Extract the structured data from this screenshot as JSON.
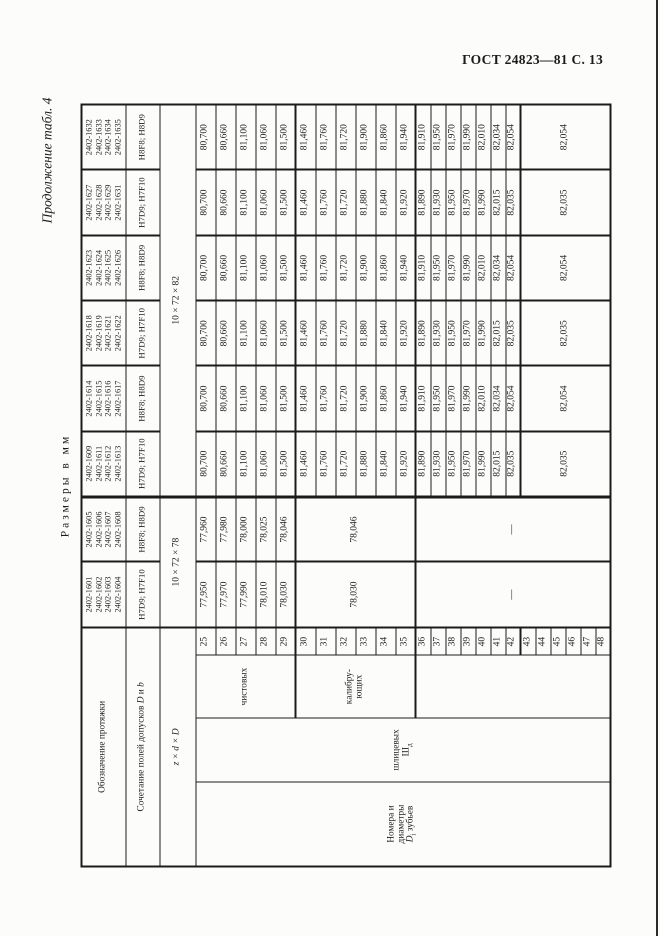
{
  "page": {
    "gost_header": "ГОСТ 24823—81 С. 13",
    "continuation_note": "Продолжение табл. 4",
    "units_heading": "Размеры в мм"
  },
  "table": {
    "corner_labels": {
      "designation": "Обозначение протяжки",
      "tolerance_pre": "Сочетание полей допусков",
      "tolerance_d": "D",
      "tolerance_and": "и",
      "tolerance_b": "b",
      "size_formula": "z × d × D"
    },
    "left_header": {
      "numbers_line1": "Номера и",
      "numbers_line2": "диаметры",
      "numbers_d": "D",
      "numbers_d_sub": "i",
      "numbers_rest": "зубьев",
      "splined_word": "шлицевых",
      "splined_base": "Ш",
      "splined_sub": "д",
      "category_finishing": "чистовых",
      "category_calibrating": [
        "калибру-",
        "ющих"
      ]
    },
    "size_spans": [
      {
        "label": "10 × 72 × 78",
        "span": 2
      },
      {
        "label": "10 × 72 × 82",
        "span": 6
      }
    ],
    "groups": [
      {
        "designations": [
          "2402-1601",
          "2402-1602",
          "2402-1603",
          "2402-1604"
        ],
        "tolerance": "H7D9; H7F10"
      },
      {
        "designations": [
          "2402-1605",
          "2402-1606",
          "2402-1607",
          "2402-1608"
        ],
        "tolerance": "H8F8; H8D9"
      },
      {
        "designations": [
          "2402-1609",
          "2402-1611",
          "2402-1612",
          "2402-1613"
        ],
        "tolerance": "H7D9; H7F10"
      },
      {
        "designations": [
          "2402-1614",
          "2402-1615",
          "2402-1616",
          "2402-1617"
        ],
        "tolerance": "H8F8; H8D9"
      },
      {
        "designations": [
          "2402-1618",
          "2402-1619",
          "2402-1621",
          "2402-1622"
        ],
        "tolerance": "H7D9; H7F10"
      },
      {
        "designations": [
          "2402-1623",
          "2402-1624",
          "2402-1625",
          "2402-1626"
        ],
        "tolerance": "H8F8; H8D9"
      },
      {
        "designations": [
          "2402-1627",
          "2402-1628",
          "2402-1629",
          "2402-1631"
        ],
        "tolerance": "H7D9; H7F10"
      },
      {
        "designations": [
          "2402-1632",
          "2402-1633",
          "2402-1634",
          "2402-1635"
        ],
        "tolerance": "H8F8; H8D9"
      }
    ],
    "rows": [
      {
        "n": "25",
        "thick": false,
        "cat": {
          "lines": [
            "чистовых"
          ],
          "rs": 5
        },
        "cells": [
          "77,950",
          "77,960",
          "80,700",
          "80,700",
          "80,700",
          "80,700",
          "80,700",
          "80,700"
        ]
      },
      {
        "n": "26",
        "thick": false,
        "cells": [
          "77,970",
          "77,980",
          "80,660",
          "80,660",
          "80,660",
          "80,660",
          "80,660",
          "80,660"
        ]
      },
      {
        "n": "27",
        "thick": false,
        "cells": [
          "77,990",
          "78,000",
          "81,100",
          "81,100",
          "81,100",
          "81,100",
          "81,100",
          "81,100"
        ]
      },
      {
        "n": "28",
        "thick": false,
        "cells": [
          "78,010",
          "78,025",
          "81,060",
          "81,060",
          "81,060",
          "81,060",
          "81,060",
          "81,060"
        ]
      },
      {
        "n": "29",
        "thick": false,
        "cells": [
          "78,030",
          "78,046",
          "81,500",
          "81,500",
          "81,500",
          "81,500",
          "81,500",
          "81,500"
        ]
      },
      {
        "n": "30",
        "thick": true,
        "cat": {
          "lines": [
            "калибру-",
            "ющих"
          ],
          "rs": 6
        },
        "cells": [
          {
            "v": "78,030",
            "rs": 6
          },
          {
            "v": "78,046",
            "rs": 6
          },
          "81,460",
          "81,460",
          "81,460",
          "81,460",
          "81,460",
          "81,460"
        ]
      },
      {
        "n": "31",
        "thick": false,
        "cells": [
          null,
          null,
          "81,760",
          "81,760",
          "81,760",
          "81,760",
          "81,760",
          "81,760"
        ]
      },
      {
        "n": "32",
        "thick": false,
        "cells": [
          null,
          null,
          "81,720",
          "81,720",
          "81,720",
          "81,720",
          "81,720",
          "81,720"
        ]
      },
      {
        "n": "33",
        "thick": false,
        "cells": [
          null,
          null,
          "81,880",
          "81,900",
          "81,880",
          "81,900",
          "81,880",
          "81,900"
        ]
      },
      {
        "n": "34",
        "thick": false,
        "cells": [
          null,
          null,
          "81,840",
          "81,860",
          "81,840",
          "81,860",
          "81,840",
          "81,860"
        ]
      },
      {
        "n": "35",
        "thick": false,
        "cells": [
          null,
          null,
          "81,920",
          "81,940",
          "81,920",
          "81,940",
          "81,920",
          "81,940"
        ]
      },
      {
        "n": "36",
        "thick": true,
        "cat": {
          "lines": [],
          "rs": 13
        },
        "cells": [
          {
            "v": "—",
            "rs": 13
          },
          {
            "v": "—",
            "rs": 13
          },
          "81,890",
          "81,910",
          "81,890",
          "81,910",
          "81,890",
          "81,910"
        ]
      },
      {
        "n": "37",
        "thick": false,
        "cells": [
          null,
          null,
          "81,930",
          "81,950",
          "81,930",
          "81,950",
          "81,930",
          "81,950"
        ]
      },
      {
        "n": "38",
        "thick": false,
        "cells": [
          null,
          null,
          "81,950",
          "81,970",
          "81,950",
          "81,970",
          "81,950",
          "81,970"
        ]
      },
      {
        "n": "39",
        "thick": false,
        "cells": [
          null,
          null,
          "81,970",
          "81,990",
          "81,970",
          "81,990",
          "81,970",
          "81,990"
        ]
      },
      {
        "n": "40",
        "thick": false,
        "cells": [
          null,
          null,
          "81,990",
          "82,010",
          "81,990",
          "82,010",
          "81,990",
          "82,010"
        ]
      },
      {
        "n": "41",
        "thick": false,
        "cells": [
          null,
          null,
          "82,015",
          "82,034",
          "82,015",
          "82,034",
          "82,015",
          "82,034"
        ]
      },
      {
        "n": "42",
        "thick": false,
        "cells": [
          null,
          null,
          "82,035",
          "82,054",
          "82,035",
          "82,054",
          "82,035",
          "82,054"
        ]
      },
      {
        "n": "43",
        "thick": true,
        "cells": [
          null,
          null,
          {
            "v": "82,035",
            "rs": 6
          },
          {
            "v": "82,054",
            "rs": 6
          },
          {
            "v": "82,035",
            "rs": 6
          },
          {
            "v": "82,054",
            "rs": 6
          },
          {
            "v": "82,035",
            "rs": 6
          },
          {
            "v": "82,054",
            "rs": 6
          }
        ]
      },
      {
        "n": "44",
        "thick": false,
        "cells": [
          null,
          null,
          null,
          null,
          null,
          null,
          null,
          null
        ]
      },
      {
        "n": "45",
        "thick": false,
        "cells": [
          null,
          null,
          null,
          null,
          null,
          null,
          null,
          null
        ]
      },
      {
        "n": "46",
        "thick": false,
        "cells": [
          null,
          null,
          null,
          null,
          null,
          null,
          null,
          null
        ]
      },
      {
        "n": "47",
        "thick": false,
        "cells": [
          null,
          null,
          null,
          null,
          null,
          null,
          null,
          null
        ]
      },
      {
        "n": "48",
        "thick": false,
        "cells": [
          null,
          null,
          null,
          null,
          null,
          null,
          null,
          null
        ]
      }
    ]
  }
}
